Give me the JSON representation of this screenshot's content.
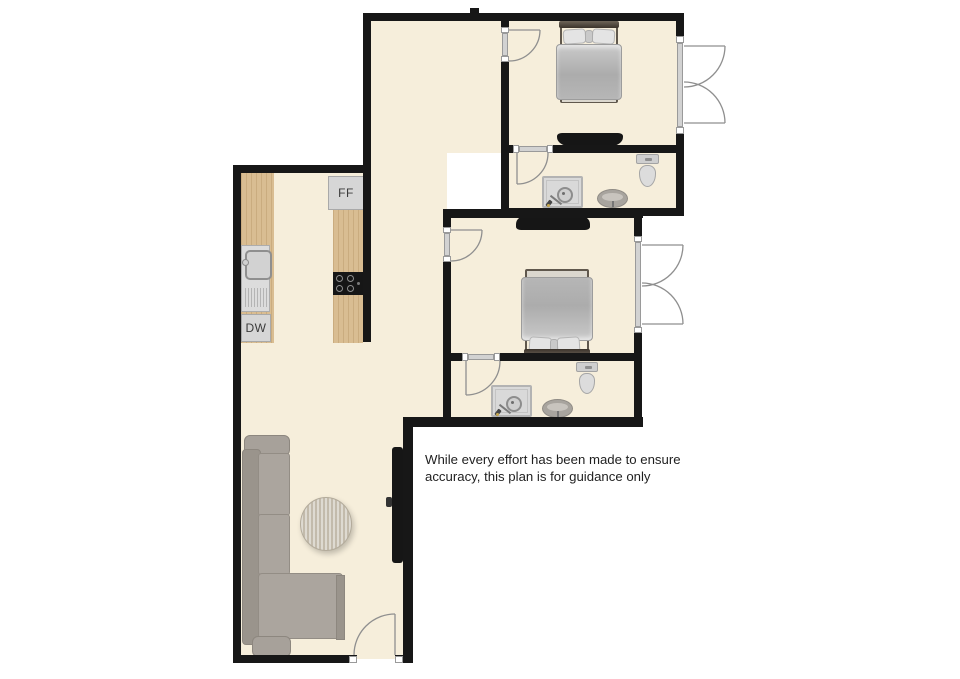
{
  "labels": {
    "fridge_freezer": "FF",
    "dishwasher": "DW"
  },
  "disclaimer": {
    "line1": "While every effort has been made to ensure",
    "line2": "accuracy, this plan is for guidance only"
  },
  "fixtures": {
    "double_bed_count": 2,
    "toilet_count": 2,
    "basin_count": 2,
    "shower_count": 2,
    "tv_count": 3,
    "corner_sofa_count": 1,
    "round_table_count": 1,
    "icons": [
      "double-bed-icon",
      "tv-icon",
      "toilet-icon",
      "basin-icon",
      "shower-icon",
      "corner-sofa-icon",
      "round-table-icon",
      "kitchen-sink-icon",
      "hob-icon",
      "fridge-freezer-icon",
      "dishwasher-icon",
      "door-swing-icon",
      "french-doors-icon"
    ]
  },
  "colors": {
    "floor": "#f6eedb",
    "wall": "#171717",
    "wood": "#d9bd92",
    "appliance": "#d6d6d6",
    "sofa": "#a7a19a",
    "duvet": "#b7b7b7",
    "fixture": "#dadada",
    "text": "#1f1f1f"
  }
}
